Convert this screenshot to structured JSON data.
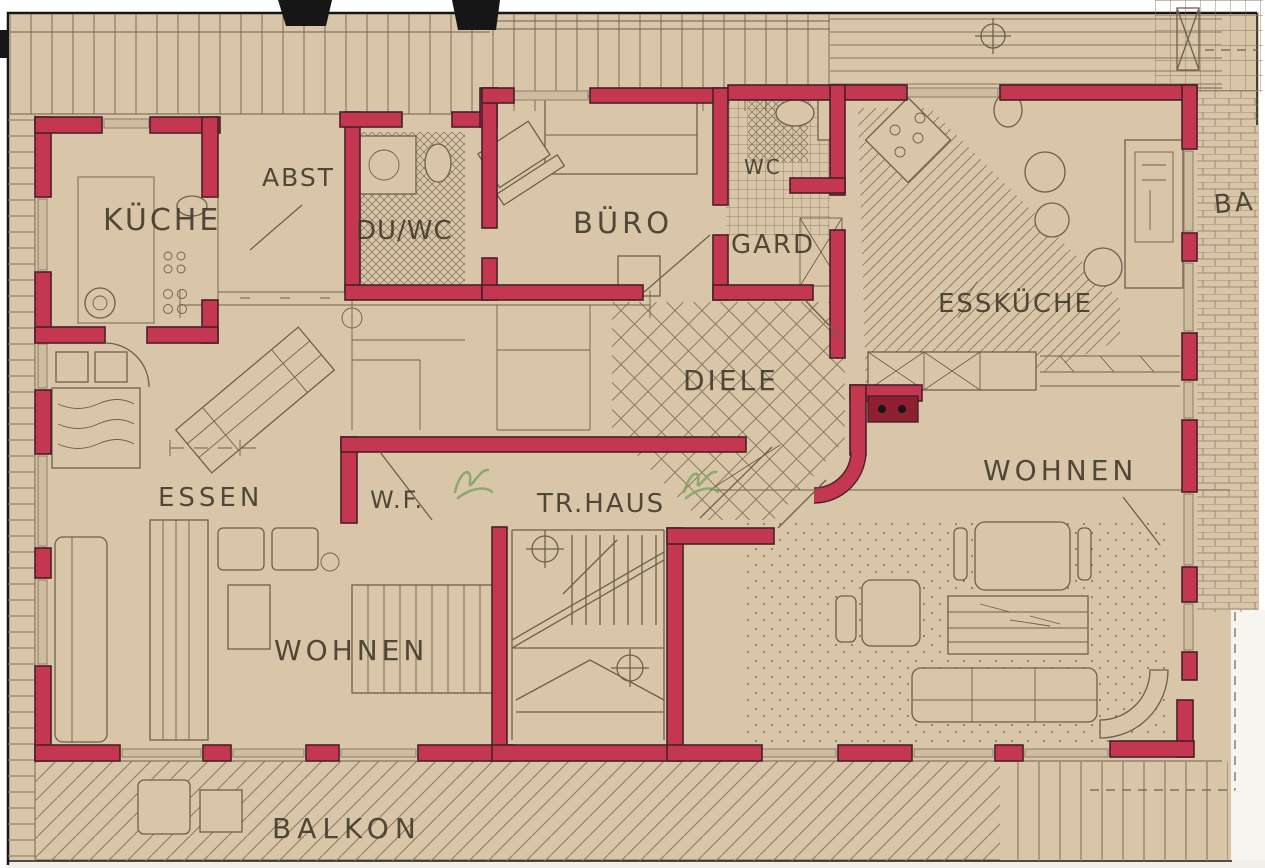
{
  "drawing": {
    "kind": "apartment floor plan (scanned blueprint)",
    "rooms": [
      {
        "id": "kueche",
        "label": "KÜCHE"
      },
      {
        "id": "abst",
        "label": "ABST"
      },
      {
        "id": "duwc",
        "label": "DU/WC"
      },
      {
        "id": "buero",
        "label": "BÜRO"
      },
      {
        "id": "wc",
        "label": "WC"
      },
      {
        "id": "gard",
        "label": "GARD"
      },
      {
        "id": "esskueche",
        "label": "ESSKÜCHE"
      },
      {
        "id": "diele",
        "label": "DIELE"
      },
      {
        "id": "essen",
        "label": "ESSEN"
      },
      {
        "id": "wf",
        "label": "W.F."
      },
      {
        "id": "trhaus",
        "label": "TR.HAUS"
      },
      {
        "id": "wohnen-left",
        "label": "WOHNEN"
      },
      {
        "id": "wohnen-right",
        "label": "WOHNEN"
      },
      {
        "id": "balkon",
        "label": "BALKON"
      },
      {
        "id": "balkon-right",
        "label": "BA"
      }
    ]
  },
  "symbols": [
    "stair-run-symbol",
    "column-circle-cross-symbol",
    "survey-circle-cross-symbol",
    "stove-burner-symbol",
    "sink-symbol",
    "wardrobe-x-symbol",
    "door-swing-symbol",
    "punch-hole-marks",
    "green-ink-handwriting"
  ],
  "colors": {
    "paper": "#d9c6a9",
    "paper_shade": "#cfbc9e",
    "wall_red": "#c43750",
    "wall_dark": "#4a2028",
    "stove_red": "#8e1f30",
    "ink": "#6e5f4b",
    "label_ink": "#3f362a",
    "window_gray": "#93846c",
    "green_ink": "#7da463",
    "black": "#161616",
    "white": "#f7f5f0"
  }
}
